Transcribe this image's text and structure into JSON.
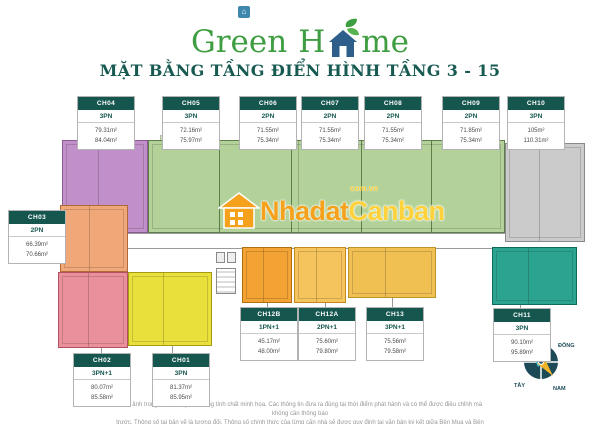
{
  "logo": {
    "part1": "Green",
    "part2": "H",
    "part3": "me",
    "badge_icon": "house-badge"
  },
  "title": "MẶT BẰNG TẦNG ĐIỂN HÌNH TẦNG 3 - 15",
  "watermark": {
    "name1": "Nhadat",
    "name2": "Canban",
    "domain": "com.vn",
    "icon": "house-icon"
  },
  "compass": {
    "north": "BẮC",
    "east": "ĐÔNG",
    "west": "TÂY",
    "south": "NAM"
  },
  "disclaimer": {
    "line1": "Hình ảnh trong tài liệu này chỉ mang tính chất minh họa. Các thông tin đưa ra đúng tại thời điểm phát hành và có thể được điều chỉnh mà không cần thông báo",
    "line2": "trước. Thông số tại bản vẽ là tương đối. Thông số chính thức của từng căn nhà sẽ được quy định tại văn bản ký kết giữa Bên Mua và Bên Bán."
  },
  "units": [
    {
      "id": "CH04",
      "type": "3PN",
      "area1": "79.31m²",
      "area2": "84.04m²",
      "color": "#c18fca"
    },
    {
      "id": "CH05",
      "type": "3PN",
      "area1": "72.16m²",
      "area2": "75.97m²",
      "color": "#b3d29a"
    },
    {
      "id": "CH06",
      "type": "2PN",
      "area1": "71.55m²",
      "area2": "75.34m²",
      "color": "#b3d29a"
    },
    {
      "id": "CH07",
      "type": "2PN",
      "area1": "71.55m²",
      "area2": "75.34m²",
      "color": "#b3d29a"
    },
    {
      "id": "CH08",
      "type": "2PN",
      "area1": "71.55m²",
      "area2": "75.34m²",
      "color": "#b3d29a"
    },
    {
      "id": "CH09",
      "type": "2PN",
      "area1": "71.85m²",
      "area2": "75.34m²",
      "color": "#b3d29a"
    },
    {
      "id": "CH10",
      "type": "3PN",
      "area1": "105m²",
      "area2": "110.31m²",
      "color": "#cbcbcb"
    },
    {
      "id": "CH03",
      "type": "2PN",
      "area1": "66.39m²",
      "area2": "70.66m²",
      "color": "#f0a878"
    },
    {
      "id": "CH02",
      "type": "3PN+1",
      "area1": "80.07m²",
      "area2": "85.58m²",
      "color": "#ea8f9c"
    },
    {
      "id": "CH01",
      "type": "3PN",
      "area1": "81.37m²",
      "area2": "85.95m²",
      "color": "#e9e03c"
    },
    {
      "id": "CH12B",
      "type": "1PN+1",
      "area1": "45.17m²",
      "area2": "48.00m²",
      "color": "#f2a333"
    },
    {
      "id": "CH12A",
      "type": "2PN+1",
      "area1": "75.60m²",
      "area2": "79.80m²",
      "color": "#f5c45c"
    },
    {
      "id": "CH13",
      "type": "3PN+1",
      "area1": "75.56m²",
      "area2": "79.58m²",
      "color": "#f0c052"
    },
    {
      "id": "CH11",
      "type": "3PN",
      "area1": "90.10m²",
      "area2": "95.89m²",
      "color": "#2aa391"
    }
  ],
  "palette": {
    "brand_green": "#3f9e42",
    "label_teal": "#15564f",
    "title_teal": "#175a52",
    "watermark_orange": "#f5a11c",
    "watermark_yellow": "#ffd23c",
    "compass_dark": "#1c4a57",
    "compass_needle_cyan": "#35c4d7",
    "compass_needle_yellow": "#f0b429"
  }
}
